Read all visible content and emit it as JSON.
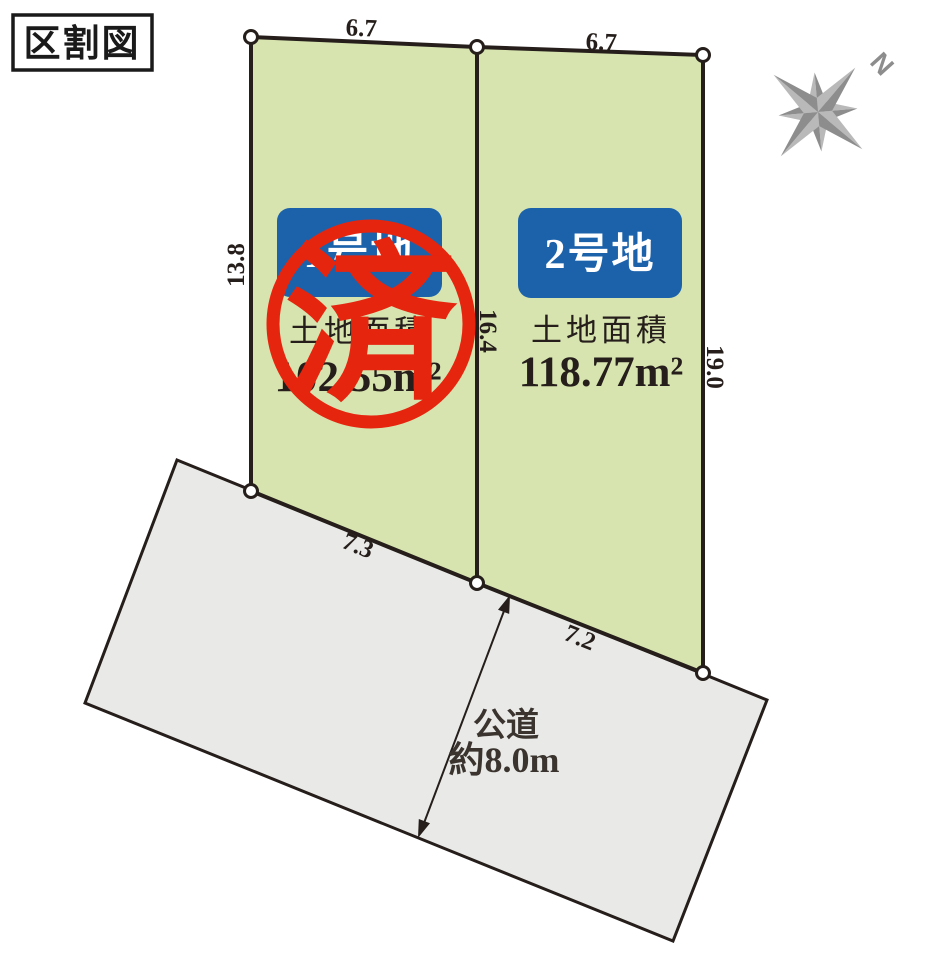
{
  "title": "区割図",
  "compass": {
    "north_label": "N"
  },
  "lots": [
    {
      "name": "1号地",
      "area_label": "土地面積",
      "area_value": "102.55m²",
      "status_stamp": "済"
    },
    {
      "name": "2号地",
      "area_label": "土地面積",
      "area_value": "118.77m²"
    }
  ],
  "dimensions": {
    "lot1_top": "6.7",
    "lot2_top": "6.7",
    "left": "13.8",
    "divider": "16.4",
    "right": "19.0",
    "lot1_bottom": "7.3",
    "lot2_bottom": "7.2"
  },
  "road": {
    "name": "公道",
    "width_label": "約8.0m"
  },
  "colors": {
    "lot_fill": "#d7e4af",
    "road_fill": "#e9eae8",
    "outline": "#251e1b",
    "lot_label_bg": "#1b62ab",
    "stamp_red": "#e6250f",
    "compass_gray": "#8d8d8d",
    "compass_gray_light": "#b9b9b9"
  }
}
